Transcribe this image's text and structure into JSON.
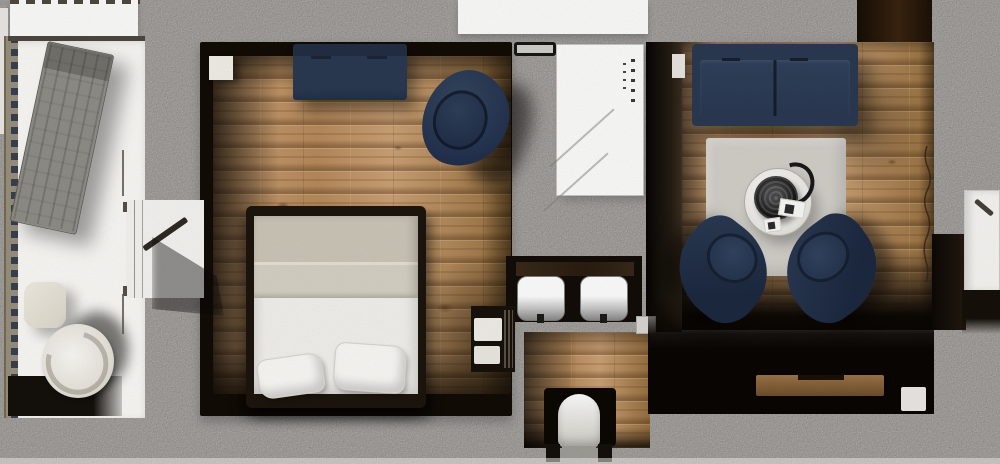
{
  "scene": {
    "type": "apartment-floor-plan-top-view",
    "style": "photorealistic 3d render",
    "rooms": [
      {
        "name": "balcony",
        "floor": "white decking",
        "items": [
          "railing",
          "sun-lounger",
          "side-table",
          "swivel-lounge-chair"
        ]
      },
      {
        "name": "bedroom",
        "floor": "light oak planks",
        "items": [
          "bench-sofa",
          "tub-armchair",
          "bedside-table",
          "double-bed",
          "duvet-blanket",
          "pillow",
          "pillow",
          "balcony-glass-door"
        ]
      },
      {
        "name": "hallway",
        "floor": "concrete screed",
        "items": [
          "wall-rack",
          "mirrored-wardrobe",
          "desk",
          "stool",
          "stool",
          "towel-shelf"
        ]
      },
      {
        "name": "bathroom",
        "floor": "light oak planks",
        "items": [
          "toilet"
        ]
      },
      {
        "name": "living-room",
        "floor": "light oak planks",
        "items": [
          "three-seat-sofa",
          "side-table",
          "area-rug",
          "round-coffee-table",
          "black-kettle",
          "paper-cards",
          "swivel-armchair",
          "swivel-armchair",
          "wooden-sideboard",
          "white-box",
          "entrance-door",
          "entry-doorway",
          "floor-crack"
        ]
      }
    ]
  },
  "colors": {
    "concrete": "#c8c5c1",
    "wood_base": "#b78b5c",
    "wood_light": "#cda276",
    "wood_dark": "#96703f",
    "wall_dark": "#120c07",
    "navy": "#2b3a52",
    "navy_dark": "#1f2c42",
    "linen": "#cdc7b9",
    "rug": "#d3d0ca",
    "white_floor": "#fbfaf7",
    "white_furniture": "#f6f5f2"
  }
}
